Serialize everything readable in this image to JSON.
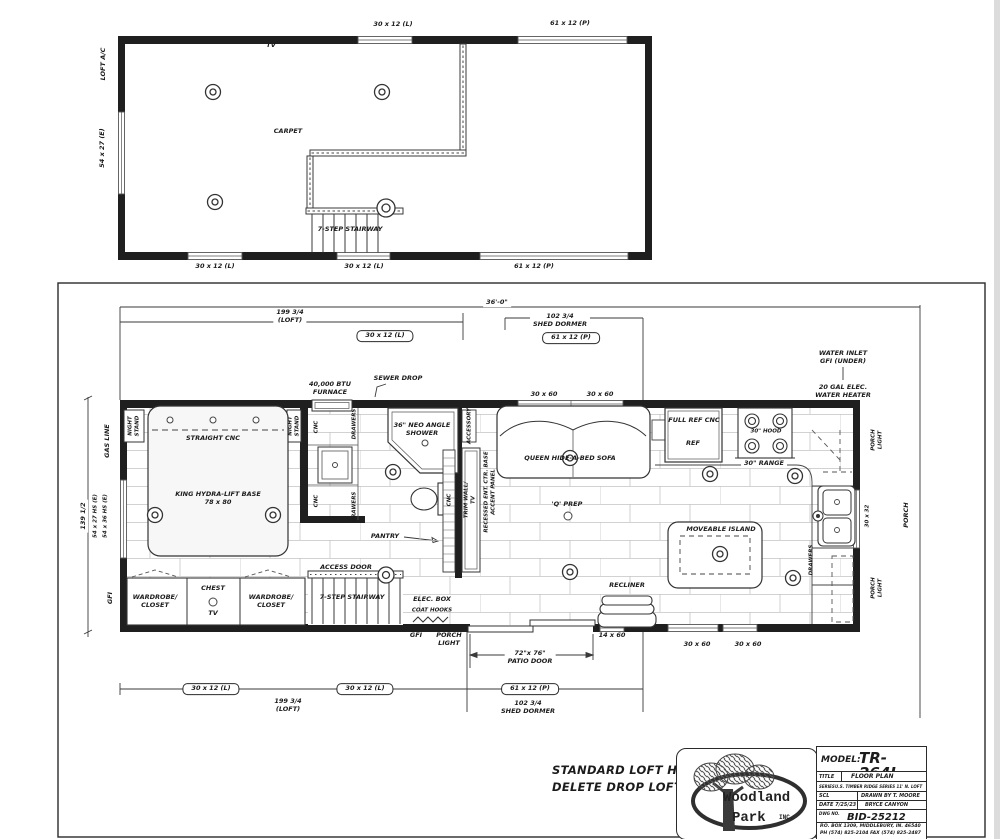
{
  "loft_plan": {
    "window_top_left": "30 x 12 (L)",
    "window_top_right": "61 x 12 (P)",
    "loft_ac": "LOFT A/C",
    "tv": "TV",
    "window_left": "54 x 27 (E)",
    "carpet": "CARPET",
    "stairway": "7-STEP STAIRWAY",
    "window_bottom_1": "30 x 12 (L)",
    "window_bottom_2": "30 x 12 (L)",
    "window_bottom_3": "61 x 12 (P)"
  },
  "main_plan": {
    "dim_overall": "36'-0\"",
    "dim_loft_top": "199 3/4\n(LOFT)",
    "win_30x12_top": "30 x 12 (L)",
    "dim_dormer_top": "102 3/4\nSHED DORMER",
    "win_61x12_top": "61 x 12 (P)",
    "water_inlet": "WATER INLET\nGFI (UNDER)",
    "water_heater": "20 GAL ELEC.\nWATER HEATER",
    "furnace": "40,000 BTU\nFURNACE",
    "sewer_drop": "SEWER DROP",
    "win_30x60_top_1": "30 x 60",
    "win_30x60_top_2": "30 x 60",
    "gas_line": "GAS LINE",
    "win_54x27": "54 x 27 HS (E)",
    "win_54x36": "54 x 36 HS (E)",
    "dim_height": "139 1/2",
    "night_stand_left": "NIGHT\nSTAND",
    "night_stand_right": "NIGHT\nSTAND",
    "straight_cnc": "STRAIGHT CNC",
    "bed": "KING HYDRA-LIFT BASE\n78 x 80",
    "gfi_left": "GFI",
    "cnc_1": "CNC",
    "drawers_1": "DRAWERS",
    "cnc_2": "CNC",
    "drawers_2": "DRAWERS",
    "shower": "36\" NEO ANGLE\nSHOWER",
    "pantry": "PANTRY",
    "cnc_3": "CNC",
    "accessory": "ACCESSORY",
    "trim_wall": "TRIM WALL/\nTV",
    "recessed_ent": "RECESSED ENT. CTR. BASE\nACCENT PANEL",
    "sofa": "QUEEN HIDE-A-BED SOFA",
    "q_prep": "'Q' PREP",
    "full_ref": "FULL REF CNC",
    "ref": "REF",
    "hood": "30\" HOOD",
    "range": "30\" RANGE",
    "porch_light_tr": "PORCH\nLIGHT",
    "win_30x32": "30 x 32",
    "porch": "PORCH",
    "porch_light_br": "PORCH\nLIGHT",
    "island": "MOVEABLE ISLAND",
    "drawers_3": "DRAWERS",
    "recliner": "RECLINER",
    "elec_box": "ELEC. BOX",
    "coat_hooks": "COAT HOOKS",
    "gfi_bottom": "GFI",
    "porch_light_b": "PORCH\nLIGHT",
    "patio_door": "72\"x 76\"\nPATIO DOOR",
    "win_14x60": "14 x 60",
    "win_30x60_b1": "30 x 60",
    "win_30x60_b2": "30 x 60",
    "access_door": "ACCESS DOOR",
    "stairway": "7-STEP STAIRWAY",
    "wardrobe_left": "WARDROBE/\nCLOSET",
    "chest": "CHEST",
    "tv": "TV",
    "wardrobe_right": "WARDROBE/\nCLOSET",
    "win_30x12_b1": "30 x 12 (L)",
    "win_30x12_b2": "30 x 12 (L)",
    "dim_loft_bottom": "199 3/4\n(LOFT)",
    "win_61x12_b": "61 x 12 (P)",
    "dim_dormer_bottom": "102 3/4\nSHED DORMER"
  },
  "notes": {
    "loft_note": "STANDARD LOFT HEIGHT\nDELETE DROP LOFT"
  },
  "title_block": {
    "model_label": "MODEL:",
    "model_value": "TR-264L",
    "title_label": "TITLE",
    "title_value": "FLOOR PLAN",
    "series_label": "SERIES",
    "series_value": "U.S. TIMBER RIDGE SERIES 11' N. LOFT",
    "scale_label": "SCL",
    "drawn_by": "DRAWN BY  T. MOORE",
    "date": "DATE 7/25/23",
    "model_name": "BRYCE CANYON",
    "dwg_label": "DWG NO.",
    "dwg_value": "BID-25212",
    "address": "P.O. BOX 1309, MIDDLEBURY, IN. 46540",
    "phone": "PH (574) 825-2104 FAX (574) 825-2487",
    "logo_line1": "Woodland",
    "logo_line2": "Park",
    "logo_inc": "INC."
  }
}
